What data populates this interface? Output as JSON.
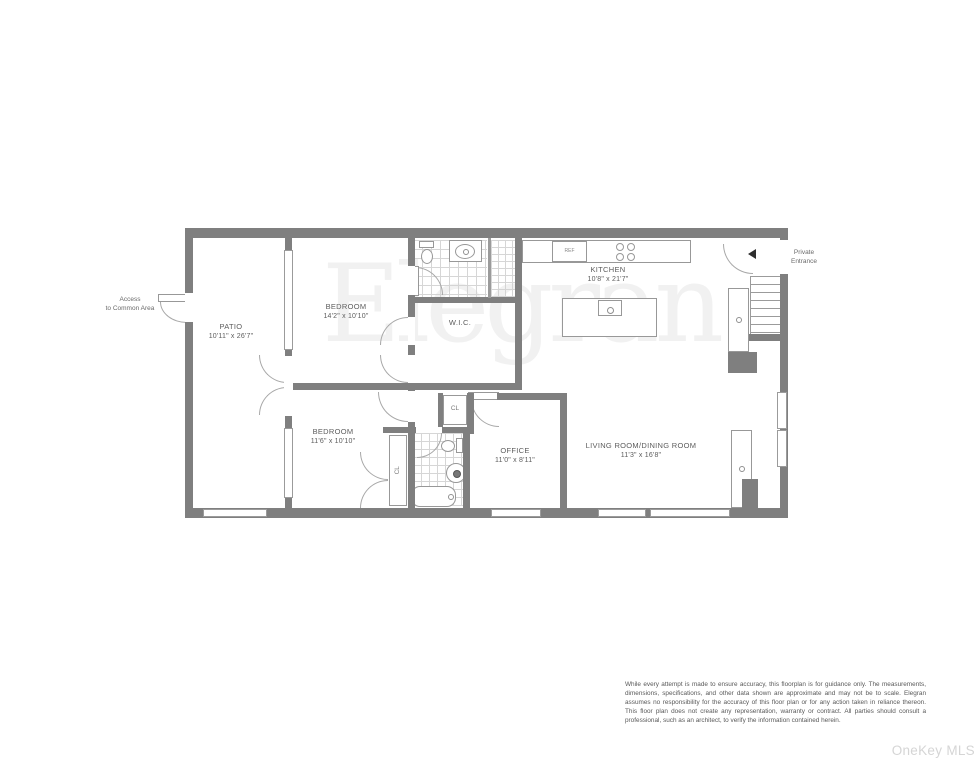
{
  "floorplan": {
    "watermark": "Elegran",
    "colors": {
      "wall": "#7f7f7f",
      "thin_line": "#9b9b9b",
      "label_text": "#5d5d5d",
      "watermark_gray": "#f1f1f1",
      "mls_gray": "#d5d5d5"
    },
    "rooms": [
      {
        "name": "PATIO",
        "dims": "10'11\" x 26'7\""
      },
      {
        "name": "BEDROOM",
        "dims": "14'2\" x 10'10\""
      },
      {
        "name": "W.I.C.",
        "dims": ""
      },
      {
        "name": "KITCHEN",
        "dims": "10'8\" x 21'7\""
      },
      {
        "name": "BEDROOM",
        "dims": "11'6\" x 10'10\""
      },
      {
        "name": "OFFICE",
        "dims": "11'0\" x 8'11\""
      },
      {
        "name": "LIVING ROOM/DINING ROOM",
        "dims": "11'3\" x 16'8\""
      }
    ],
    "labels": {
      "access_line1": "Access",
      "access_line2": "to Common Area",
      "entrance_line1": "Private",
      "entrance_line2": "Entrance",
      "closet_office": "CL",
      "closet_bedroom": "CL",
      "fridge": "REF"
    }
  },
  "footer": {
    "disclaimer": "While every attempt is made to ensure accuracy, this floorplan is for guidance only. The measurements, dimensions, specifications, and other data shown are approximate and may not be to scale. Elegran assumes no responsibility for the accuracy of this floor plan or for any action taken in reliance thereon. This floor plan does not create any representation, warranty or contract. All parties should consult a professional, such as an architect, to verify the information contained herein.",
    "mls_watermark": "OneKey MLS"
  }
}
